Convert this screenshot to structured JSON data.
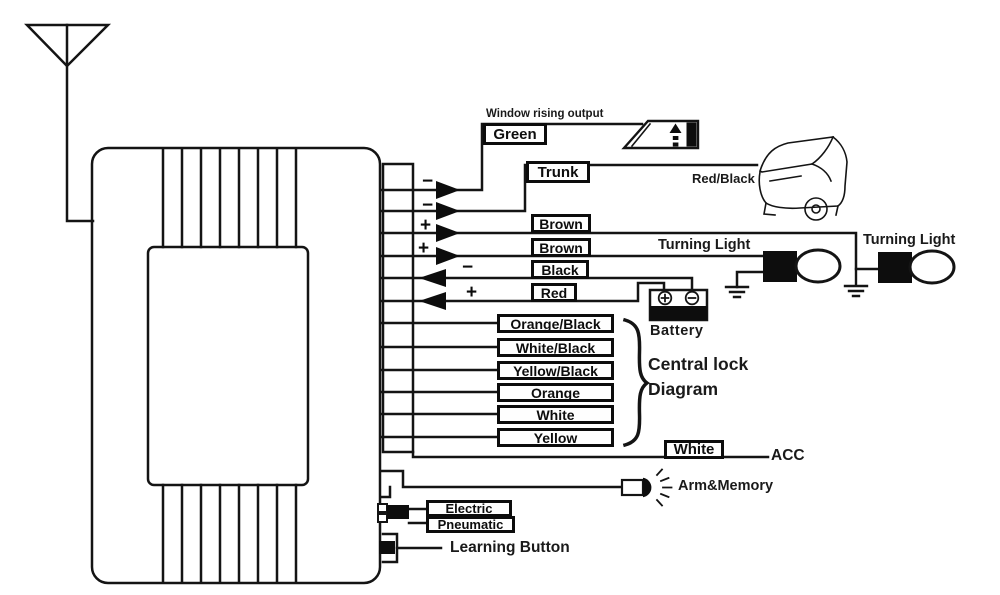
{
  "diagram": {
    "note_window": "Window rising output",
    "tags": {
      "green": "Green",
      "trunk": "Trunk",
      "brown1": "Brown",
      "brown2": "Brown",
      "black": "Black",
      "red": "Red",
      "lock1": "Orange/Black",
      "lock2": "White/Black",
      "lock3": "Yellow/Black",
      "lock4": "Orange",
      "lock5": "White",
      "lock6": "Yellow",
      "acc_wire": "White",
      "electric": "Electric",
      "pneumatic": "Pneumatic"
    },
    "polarity": {
      "green": "−",
      "trunk": "−",
      "brown1": "+",
      "brown2": "+",
      "black": "−",
      "red": "+"
    },
    "labels": {
      "red_black": "Red/Black",
      "turning_light_left": "Turning Light",
      "turning_light_right": "Turning Light",
      "battery": "Battery",
      "central_lock_line1": "Central lock",
      "central_lock_line2": "Diagram",
      "acc": "ACC",
      "arm_memory": "Arm&Memory",
      "learning_button": "Learning Button"
    },
    "icons": {
      "antenna": "antenna-icon",
      "window_rising": "window-rising-icon",
      "car_trunk": "car-open-trunk-icon",
      "turning_light": "turn-light-bulb-icon",
      "battery": "battery-icon",
      "ground": "ground-icon",
      "lamp": "indicator-lamp-icon",
      "learning_button": "learning-button-icon"
    },
    "colors": {
      "line": "#141414",
      "background": "#ffffff"
    }
  }
}
